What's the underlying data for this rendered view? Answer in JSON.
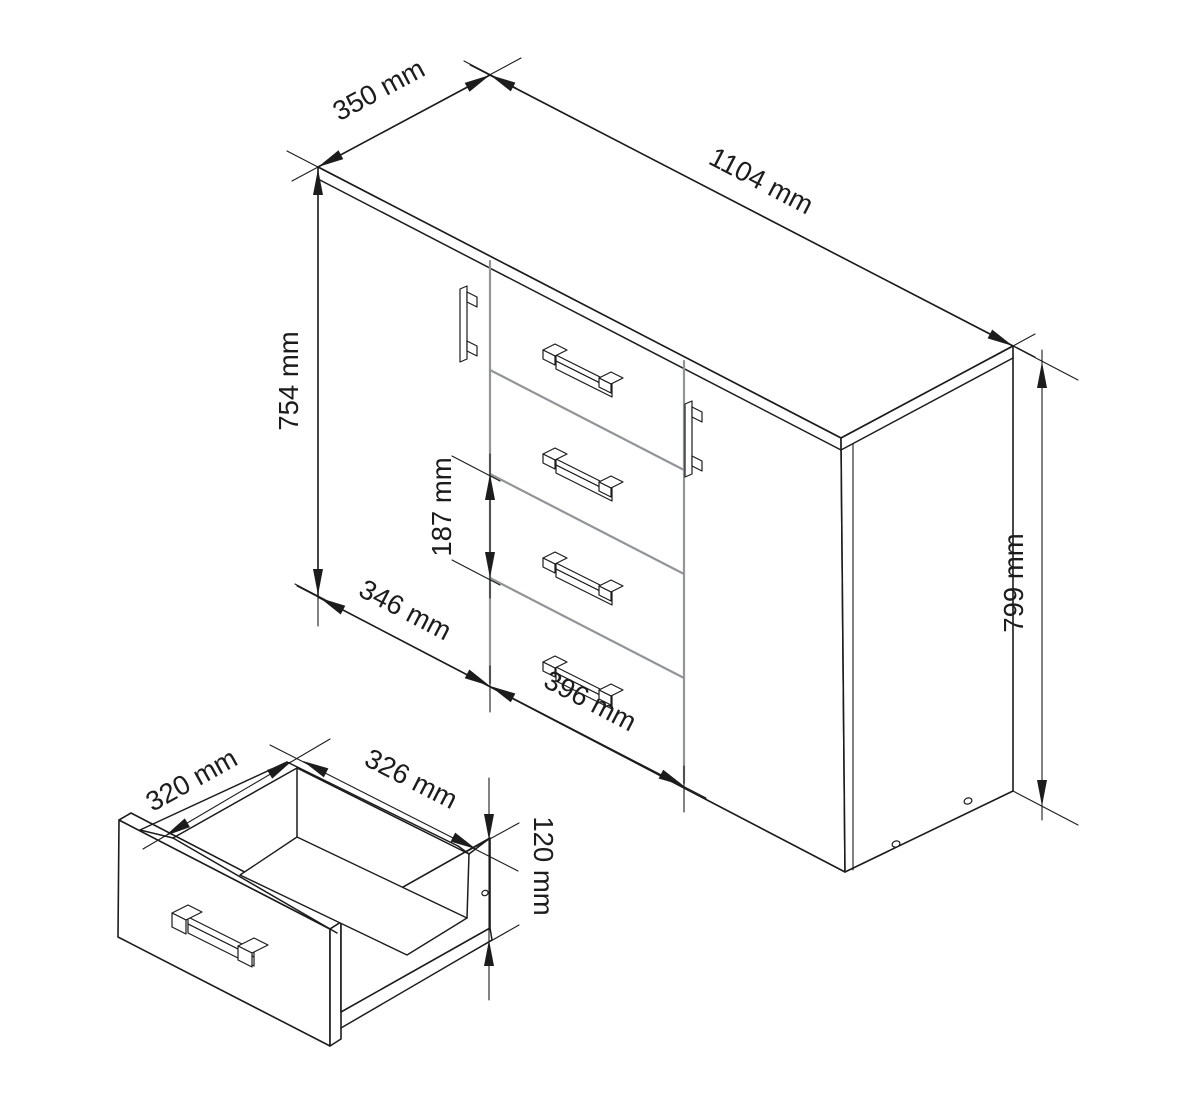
{
  "dims": {
    "cabinet_depth": "350 mm",
    "cabinet_width": "1104 mm",
    "door_height": "754 mm",
    "drawer_front_height": "187 mm",
    "door_width": "346 mm",
    "drawer_width": "396 mm",
    "cabinet_height": "799 mm",
    "drawer_inner_depth": "320 mm",
    "drawer_inner_width": "326 mm",
    "drawer_side_height": "120 mm"
  },
  "colors": {
    "line": "#1c1c1c",
    "separator": "#919599",
    "background": "#ffffff"
  }
}
